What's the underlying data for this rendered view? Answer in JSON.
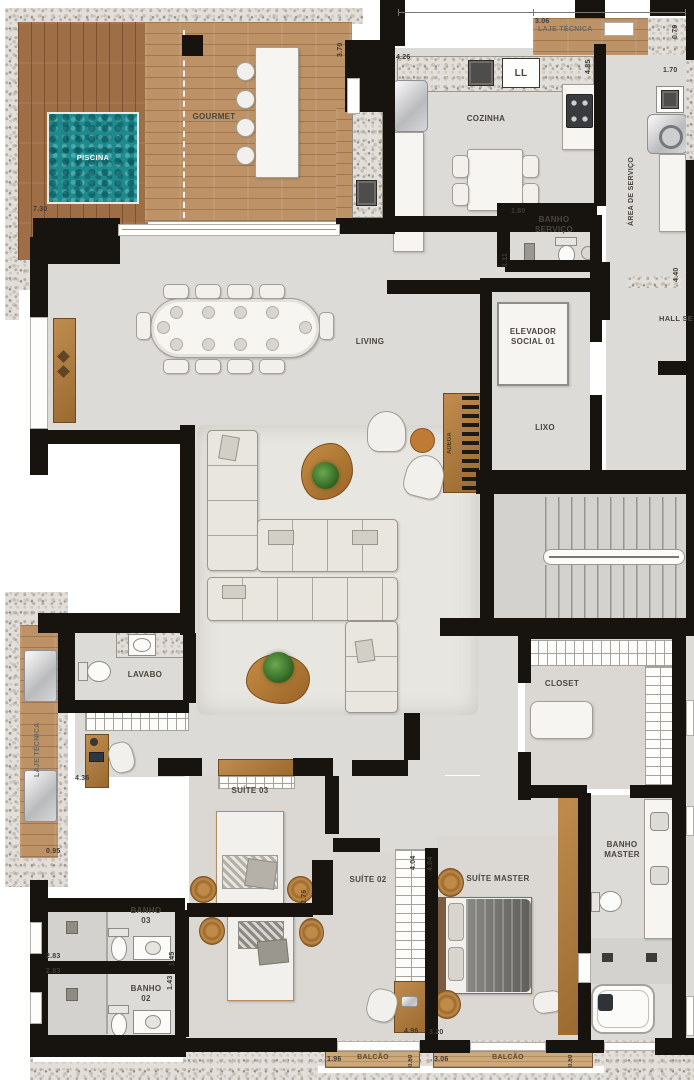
{
  "labels": {
    "piscina": "PISCINA",
    "gourmet": "GOURMET",
    "laje_tecnica_top": "LAJE TÉCNICA",
    "cozinha": "COZINHA",
    "sink_tag": "LL",
    "area_de_servico": "ÁREA DE SERVIÇO",
    "banho_servico": "BANHO\nSERVIÇO",
    "elevador": "ELEVADOR\nSOCIAL 01",
    "hall_servico": "HALL SE",
    "lixo": "LIXO",
    "living": "LIVING",
    "adega": "ADEGA",
    "lavabo": "LAVABO",
    "laje_tecnica_left": "LAJE TÉCNICA",
    "suite_03": "SUÍTE 03",
    "suite_02": "SUÍTE 02",
    "suite_master": "SUÍTE MASTER",
    "closet": "CLOSET",
    "banho_master": "BANHO\nMASTER",
    "banho_03": "BANHO\n03",
    "banho_02": "BANHO\n02",
    "balcao_1": "BALCÃO",
    "balcao_2": "BALCÃO"
  },
  "dimensions": {
    "terraco_largura": "7.30",
    "gourmet_altura": "3.70",
    "laje_top_largura": "3.06",
    "laje_top_altura": "0.79",
    "cozinha_largura": "4.26",
    "cozinha_altura": "4.85",
    "tanque": "1.70",
    "banho_servico_largura": "1.80",
    "banho_servico_altura": "1.11",
    "area_servico_altura": "4.40",
    "hall_intimo": "0.95",
    "suite03_largura": "4.36",
    "suite03_altura": "2.76",
    "banho03_largura": "2.83",
    "banho03_altura": "1.45",
    "banho02_largura": "2.83",
    "ban02_altura_key": "1.43",
    "banho02_altura": "1.43",
    "suite02_altura": "4.04",
    "suite_master_altura": "4.04",
    "suite02_largura": "4.96",
    "suite_master_largura": "3.20",
    "balcao1_largura": "1.96",
    "balcao1_profundidade": "0.60",
    "balcao2_largura": "3.06",
    "balcao2_profundidade": "0.60"
  }
}
